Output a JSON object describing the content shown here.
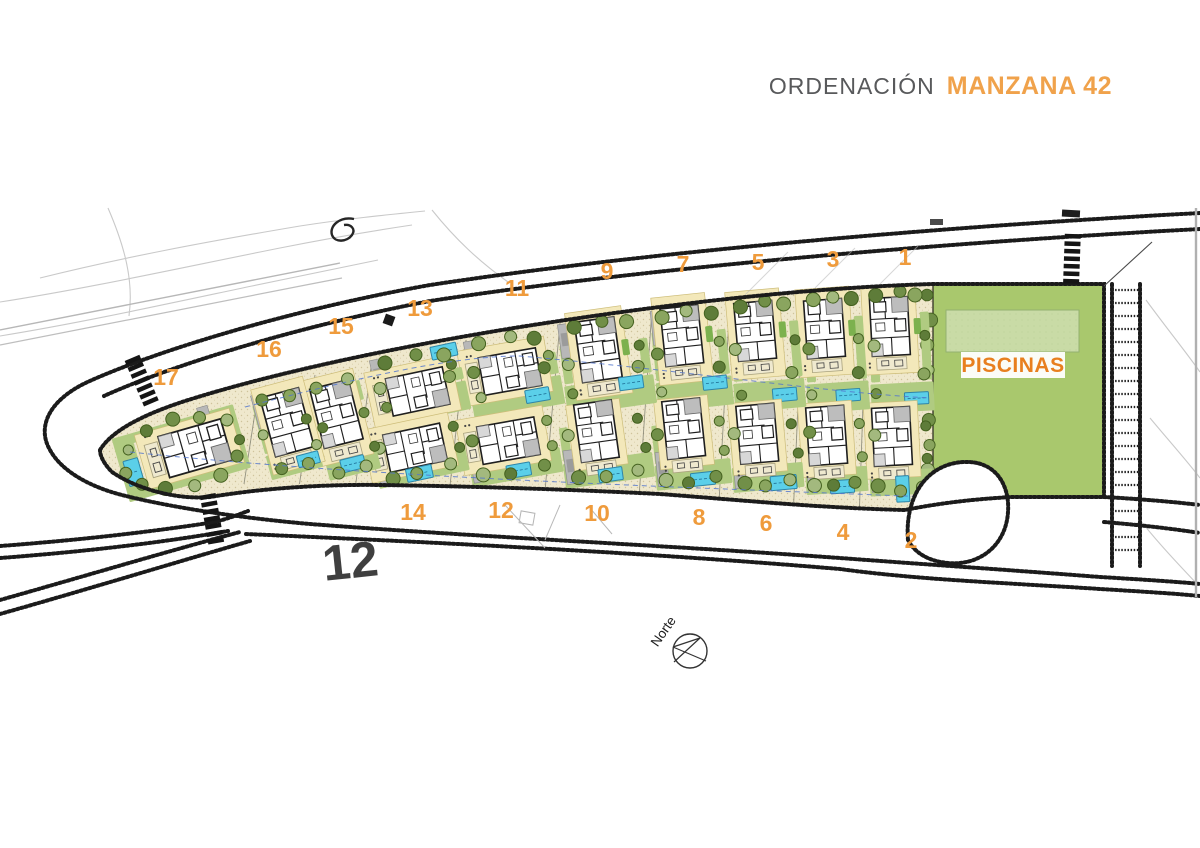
{
  "title": {
    "prefix": "ORDENACIÓN",
    "highlight": "MANZANA 42"
  },
  "labels": {
    "piscinas": "PISCINAS",
    "north": "Norte",
    "underlay_parcel_number": "12"
  },
  "colors": {
    "accent_orange": "#ef9b3c",
    "title_gray": "#58595b",
    "title_orange": "#f0a24b",
    "piscinas_text": "#e87f1f",
    "parcel_beige": "#efe8cd",
    "speckle": "#c9bc92",
    "lawn_green": "#b0cb81",
    "bright_green": "#7cb14e",
    "piscinas_green": "#a9c86d",
    "piscinas_pool": "#c9dba6",
    "pool_cyan": "#5bcfe9",
    "pool_edge": "#2e85a8",
    "road_dark": "#1b1b1b",
    "pad_yellow": "#f3e8ba",
    "driveway_gray": "#b8b8b8",
    "tree_palette": [
      "#5e7c39",
      "#718f48",
      "#8aa55f",
      "#a3b97e"
    ],
    "utility_blue": "#5577cc"
  },
  "compass": {
    "x": 690,
    "y": 651,
    "r": 17,
    "label_x": 667,
    "label_y": 634,
    "label_rot": -55
  },
  "piscinas_area": {
    "x": 933,
    "y": 284,
    "w": 171,
    "h": 213,
    "pool": {
      "x": 946,
      "y": 310,
      "w": 133,
      "h": 42
    },
    "chip": {
      "x": 961,
      "y": 352,
      "w": 104,
      "h": 26
    },
    "label_x": 1013,
    "label_y": 372
  },
  "underlay12": {
    "x": 352,
    "y": 578,
    "rot": -6,
    "size": 50
  },
  "plots": [
    {
      "n": "1",
      "cx": 900,
      "cy": 348,
      "w": 65,
      "h": 130,
      "tilt": -3,
      "kind": "top",
      "v": [
        -9,
        -17,
        0,
        1.0
      ],
      "pool": [
        14,
        51,
        24,
        12
      ],
      "lbl": [
        905,
        257
      ]
    },
    {
      "n": "2",
      "cx": 900,
      "cy": 456,
      "w": 65,
      "h": 80,
      "tilt": -3,
      "kind": "bot",
      "v": [
        -7,
        -15,
        0,
        1.0
      ],
      "pool": [
        1,
        33,
        13,
        26
      ],
      "lbl": [
        911,
        540
      ]
    },
    {
      "n": "3",
      "cx": 835,
      "cy": 350,
      "w": 64,
      "h": 125,
      "tilt": -4,
      "kind": "top",
      "v": [
        -9,
        -17,
        0,
        1.0
      ],
      "pool": [
        10,
        46,
        24,
        12
      ],
      "lbl": [
        833,
        259
      ]
    },
    {
      "n": "4",
      "cx": 835,
      "cy": 455,
      "w": 64,
      "h": 78,
      "tilt": -4,
      "kind": "bot",
      "v": [
        -7,
        -15,
        0,
        1.0
      ],
      "pool": [
        5,
        32,
        24,
        13
      ],
      "lbl": [
        843,
        532
      ]
    },
    {
      "n": "5",
      "cx": 766,
      "cy": 352,
      "w": 73,
      "h": 118,
      "tilt": -5,
      "kind": "top",
      "v": [
        -9,
        -17,
        0,
        1.0
      ],
      "pool": [
        15,
        44,
        24,
        13
      ],
      "lbl": [
        758,
        262
      ]
    },
    {
      "n": "6",
      "cx": 766,
      "cy": 453,
      "w": 73,
      "h": 76,
      "tilt": -5,
      "kind": "bot",
      "v": [
        -7,
        -15,
        0,
        1.0
      ],
      "pool": [
        15,
        31,
        26,
        14
      ],
      "lbl": [
        766,
        523
      ]
    },
    {
      "n": "7",
      "cx": 691,
      "cy": 356,
      "w": 78,
      "h": 107,
      "tilt": -6,
      "kind": "top",
      "v": [
        -7,
        -16,
        0,
        1.0
      ],
      "pool": [
        21,
        29,
        24,
        13
      ],
      "lbl": [
        683,
        264
      ]
    },
    {
      "n": "8",
      "cx": 691,
      "cy": 451,
      "w": 78,
      "h": 74,
      "tilt": -6,
      "kind": "bot",
      "v": [
        -5,
        -18,
        0,
        1.0
      ],
      "pool": [
        9,
        29,
        24,
        13
      ],
      "lbl": [
        699,
        517
      ]
    },
    {
      "n": "9",
      "cx": 606,
      "cy": 362,
      "w": 92,
      "h": 97,
      "tilt": -8,
      "kind": "top",
      "v": [
        -6,
        -8,
        0,
        1.05
      ],
      "pool": [
        22,
        24,
        24,
        13
      ],
      "lbl": [
        607,
        271
      ]
    },
    {
      "n": "10",
      "cx": 606,
      "cy": 449,
      "w": 92,
      "h": 70,
      "tilt": -8,
      "kind": "bot",
      "v": [
        -7,
        -14,
        0,
        1.0
      ],
      "pool": [
        1,
        26,
        24,
        13
      ],
      "lbl": [
        597,
        513
      ]
    },
    {
      "n": "11",
      "cx": 513,
      "cy": 371,
      "w": 94,
      "h": 84,
      "tilt": -10,
      "kind": "top",
      "v": [
        -8,
        0,
        90,
        1.0
      ],
      "pool": [
        20,
        28,
        24,
        13
      ],
      "lbl": [
        517,
        288
      ]
    },
    {
      "n": "12",
      "cx": 513,
      "cy": 449,
      "w": 94,
      "h": 64,
      "tilt": -10,
      "kind": "bot",
      "v": [
        -8,
        -9,
        90,
        1.0
      ],
      "pool": [
        2,
        22,
        24,
        13
      ],
      "lbl": [
        501,
        510
      ]
    },
    {
      "n": "13",
      "cx": 419,
      "cy": 383,
      "w": 94,
      "h": 74,
      "tilt": -12,
      "kind": "top",
      "v": [
        -8,
        8,
        90,
        1.0
      ],
      "pool": [
        31,
        -26,
        26,
        13
      ],
      "lbl": [
        420,
        308
      ]
    },
    {
      "n": "14",
      "cx": 419,
      "cy": 452,
      "w": 94,
      "h": 58,
      "tilt": -12,
      "kind": "bot",
      "v": [
        -8,
        -5,
        90,
        1.0
      ],
      "pool": [
        -4,
        21,
        26,
        13
      ],
      "lbl": [
        413,
        512
      ]
    },
    {
      "n": "15",
      "cx": 343,
      "cy": 424,
      "w": 57,
      "h": 106,
      "tilt": -14,
      "kind": "single",
      "v": [
        -4,
        -6,
        0,
        1.05
      ],
      "pool": [
        0,
        41,
        24,
        13
      ],
      "lbl": [
        341,
        326
      ]
    },
    {
      "n": "16",
      "cx": 286,
      "cy": 430,
      "w": 57,
      "h": 92,
      "tilt": -15,
      "kind": "single",
      "v": [
        3,
        -2,
        0,
        1.05
      ],
      "pool": [
        14,
        34,
        22,
        12
      ],
      "lbl": [
        269,
        349
      ]
    },
    {
      "n": "17",
      "cx": 182,
      "cy": 452,
      "w": 128,
      "h": 76,
      "tilt": -16,
      "kind": "tip",
      "v": [
        8,
        0,
        90,
        1.12
      ],
      "pool": [
        -52,
        6,
        15,
        26
      ],
      "lbl": [
        166,
        377
      ]
    }
  ]
}
